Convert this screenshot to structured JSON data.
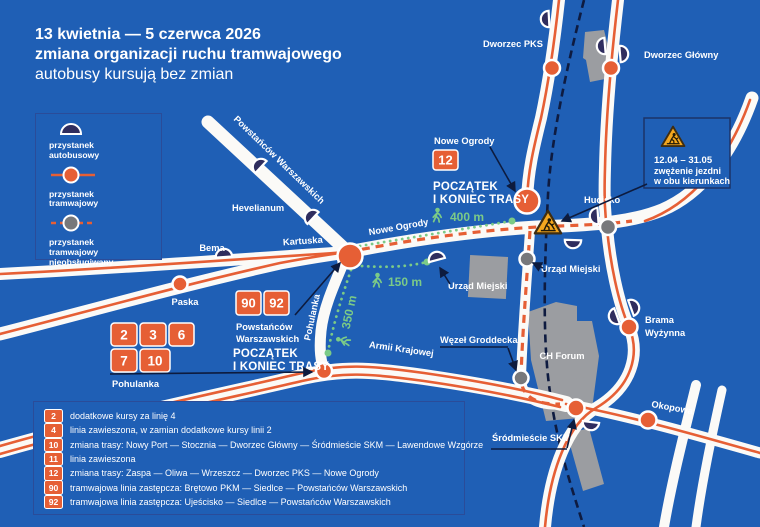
{
  "title": {
    "line1": "13 kwietnia — 5 czerwca 2026",
    "line2": "zmiana organizacji ruchu tramwajowego",
    "line3": "autobusy kursują bez zmian"
  },
  "stop_legend": {
    "items": [
      {
        "lines": [
          "przystanek",
          "autobusowy"
        ]
      },
      {
        "lines": [
          "przystanek",
          "tramwajowy"
        ]
      },
      {
        "lines": [
          "przystanek",
          "tramwajowy",
          "nieobsługiwany"
        ]
      }
    ]
  },
  "routes_legend": {
    "rows": [
      {
        "num": "2",
        "text": "dodatkowe kursy za linię 4"
      },
      {
        "num": "4",
        "text": "linia zawieszona, w zamian dodatkowe kursy linii 2"
      },
      {
        "num": "10",
        "text": "zmiana trasy: Nowy Port — Stocznia — Dworzec Główny — Śródmieście SKM — Lawendowe Wzgórze"
      },
      {
        "num": "11",
        "text": "linia zawieszona"
      },
      {
        "num": "12",
        "text": "zmiana trasy: Zaspa — Oliwa — Wrzeszcz — Dworzec PKS — Nowe Ogrody"
      },
      {
        "num": "90",
        "text": "tramwajowa linia zastępcza: Brętowo PKM — Siedlce — Powstańców Warszawskich"
      },
      {
        "num": "92",
        "text": "tramwajowa linia zastępcza: Ujeścisko — Siedlce — Powstańców Warszawskich"
      }
    ]
  },
  "map": {
    "labels": {
      "dworzec_pks": "Dworzec PKS",
      "dworzec_glowny": "Dworzec Główny",
      "powstancow_road": "Powstańców Warszawskich",
      "hevelianum": "Hevelianum",
      "bema": "Bema",
      "kartuska": "Kartuska",
      "paska": "Paska",
      "nowe_ogrody_road": "Nowe Ogrody",
      "hucisko": "Hucisko",
      "armii_krajowej": "Armii Krajowej",
      "pohulanka_road": "Pohulanka",
      "urzad_miejski_bus": "Urząd Miejski",
      "urzad_miejski_tram": "Urząd Miejski",
      "wezel_groddecka": "Węzeł Groddecka",
      "ch_forum": "CH Forum",
      "brama_wyzynna_line1": "Brama",
      "brama_wyzynna_line2": "Wyżynna",
      "okopowa": "Okopowa",
      "srodmiescie_skm": "Śródmieście SKM"
    },
    "terminus_nowe_ogrody": {
      "stop_name": "Nowe Ogrody",
      "badge": "12",
      "caption_line1": "POCZĄTEK",
      "caption_line2": "I KONIEC TRASY"
    },
    "terminus_powstancow": {
      "badges": [
        "90",
        "92"
      ],
      "stop_name_line1": "Powstańców",
      "stop_name_line2": "Warszawskich",
      "caption_line1": "POCZĄTEK",
      "caption_line2": "I KONIEC TRASY"
    },
    "pohulanka_stop": {
      "badges_row1": [
        "2",
        "3",
        "6"
      ],
      "badges_row2": [
        "7",
        "10"
      ],
      "stop_name": "Pohulanka"
    },
    "walk_distances": {
      "d400": "400 m",
      "d150": "150 m",
      "d350": "350 m"
    },
    "roadworks": {
      "dates": "12.04 – 31.05",
      "line1": "zwężenie jezdni",
      "line2": "w obu kierunkach"
    }
  },
  "colors": {
    "background": "#1f5fb5",
    "road": "#fbfaf7",
    "tram_line": "#e65f35",
    "bus_stop": "#2f2d5e",
    "closed_stop": "#77787b",
    "walk_green": "#7bca87",
    "building": "#9b9da1",
    "railway": "#0e1b40",
    "warning": "#f4a71f"
  }
}
